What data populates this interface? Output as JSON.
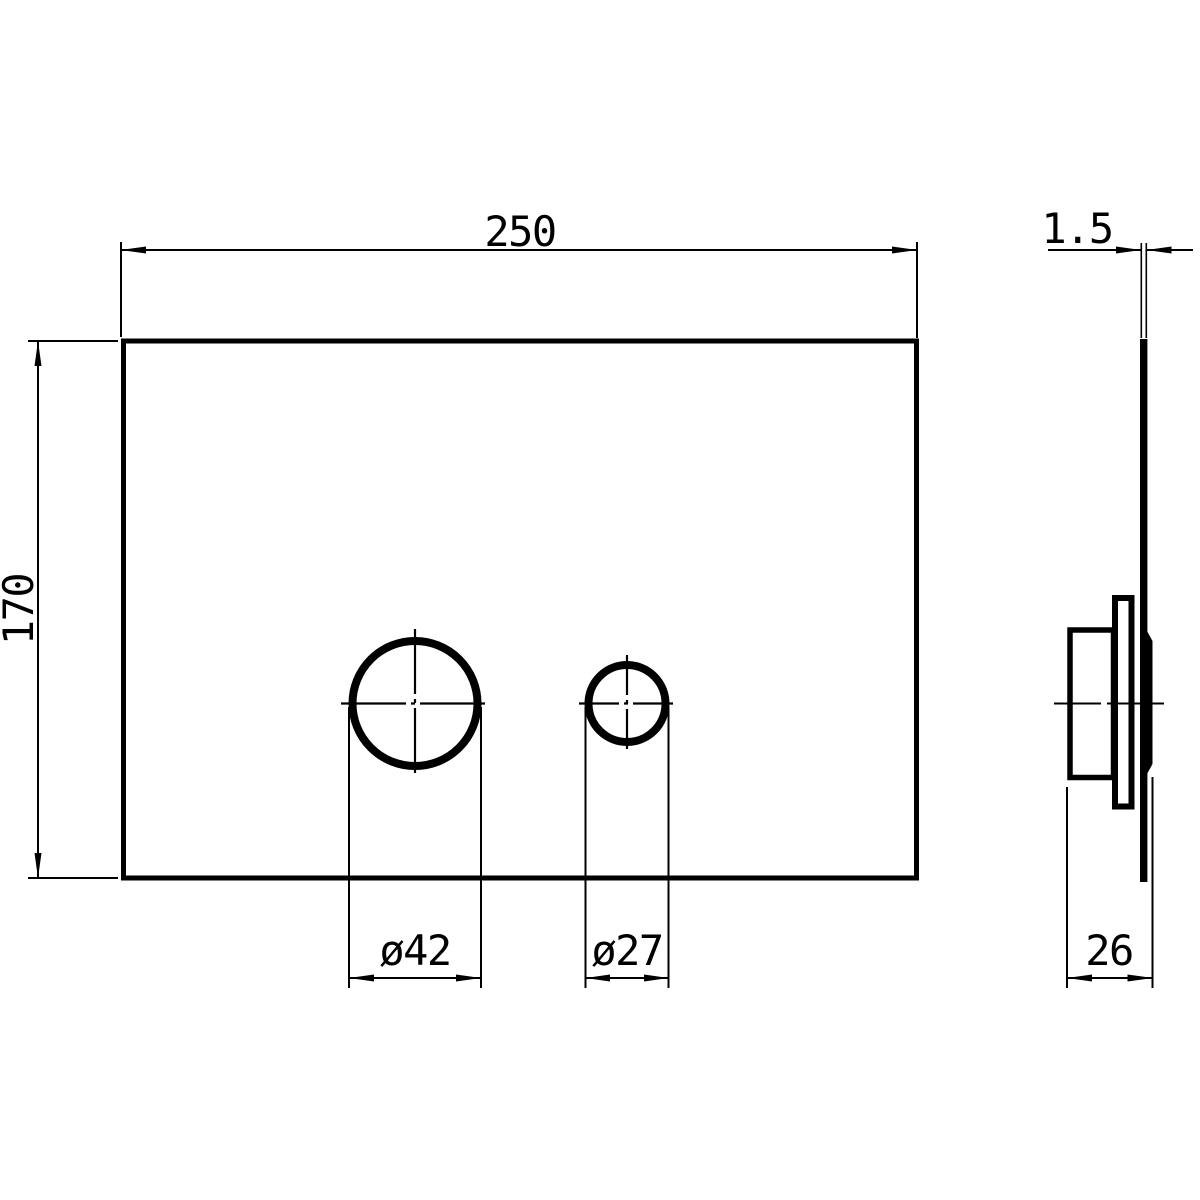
{
  "drawing": {
    "background_color": "#ffffff",
    "line_color": "#000000",
    "front_view": {
      "width_dim": "250",
      "height_dim": "170",
      "large_hole_dia_dim": "ø42",
      "small_hole_dia_dim": "ø27"
    },
    "side_view": {
      "plate_thickness_dim": "1.5",
      "overall_depth_dim": "26"
    }
  }
}
